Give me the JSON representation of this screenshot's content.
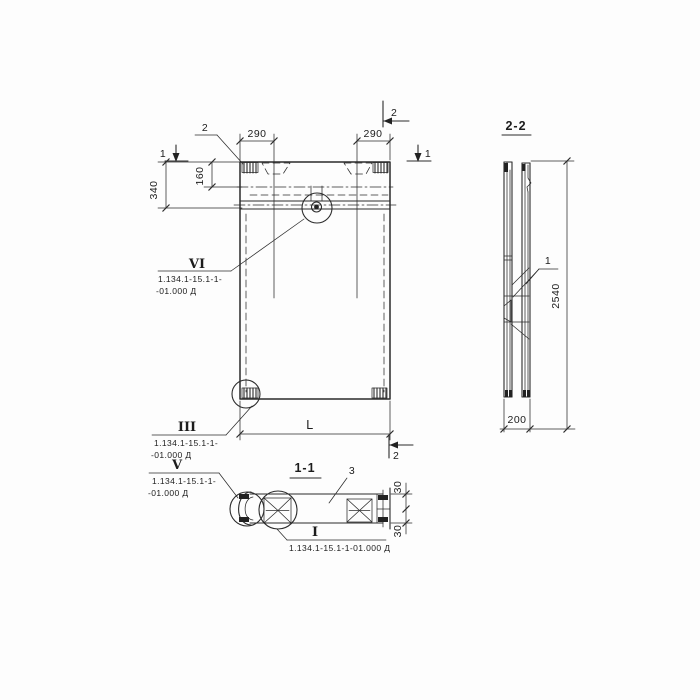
{
  "front_view": {
    "marks": {
      "cut1_left": "1",
      "cut1_right": "1",
      "cut2_leader": "2",
      "cut2_top_right": "2",
      "cut2_bottom_right": "2"
    },
    "dims": {
      "recess_left": "290",
      "recess_right": "290",
      "band": "340",
      "first_line": "160",
      "length": "L"
    }
  },
  "side_view": {
    "title": "2-2",
    "item_label": "1",
    "dims": {
      "height": "2540",
      "thickness": "200"
    }
  },
  "section_view": {
    "title": "1-1",
    "item_label": "3",
    "dims": {
      "flange_top": "30",
      "flange_bottom": "30"
    }
  },
  "callouts": {
    "vi": {
      "numeral": "VI",
      "doc1": "1.134.1-15.1-1-",
      "doc2": "-01.000 Д"
    },
    "iii": {
      "numeral": "III",
      "doc1": "1.134.1-15.1-1-",
      "doc2": "-01.000 Д"
    },
    "v": {
      "numeral": "V",
      "doc1": "1.134.1-15.1-1-",
      "doc2": "-01.000 Д"
    },
    "i": {
      "numeral": "I",
      "doc1": "1.134.1-15.1-1-01.000 Д"
    }
  }
}
